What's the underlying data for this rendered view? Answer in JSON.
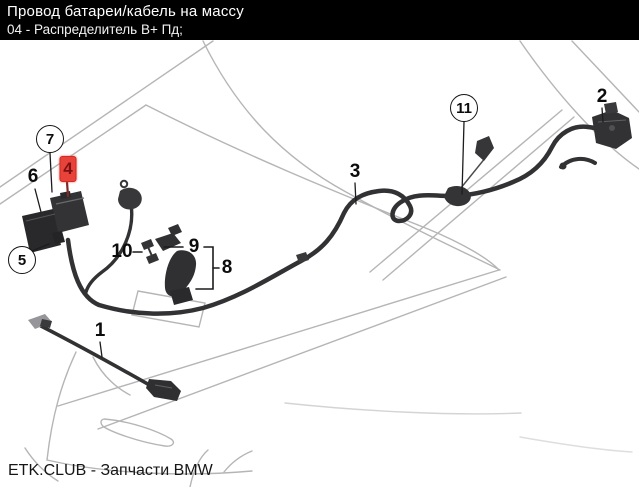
{
  "header": {
    "title": "Провод батареи/кабель на массу",
    "subtitle": "04 - Распределитель B+ Пд;"
  },
  "footer": {
    "text": "ETK.CLUB - Запчасти BMW"
  },
  "diagram": {
    "type": "parts-diagram",
    "subject": "battery-cable-ground-cable-routing",
    "highlighted_callout": "4",
    "colors": {
      "header_bg": "#000000",
      "header_fg": "#ffffff",
      "highlight": "#e8433a",
      "highlight_glyph": "#7d1013",
      "harness": "#323234",
      "car_outline": "#b5b5b7",
      "callout_ink": "#0c0c0c"
    },
    "callouts": [
      {
        "label": "1",
        "style": "plain"
      },
      {
        "label": "2",
        "style": "plain"
      },
      {
        "label": "3",
        "style": "plain"
      },
      {
        "label": "4",
        "style": "highlight"
      },
      {
        "label": "5",
        "style": "circle"
      },
      {
        "label": "6",
        "style": "plain"
      },
      {
        "label": "7",
        "style": "circle"
      },
      {
        "label": "8",
        "style": "plain"
      },
      {
        "label": "9",
        "style": "plain"
      },
      {
        "label": "10",
        "style": "plain"
      },
      {
        "label": "11",
        "style": "circle"
      }
    ]
  }
}
